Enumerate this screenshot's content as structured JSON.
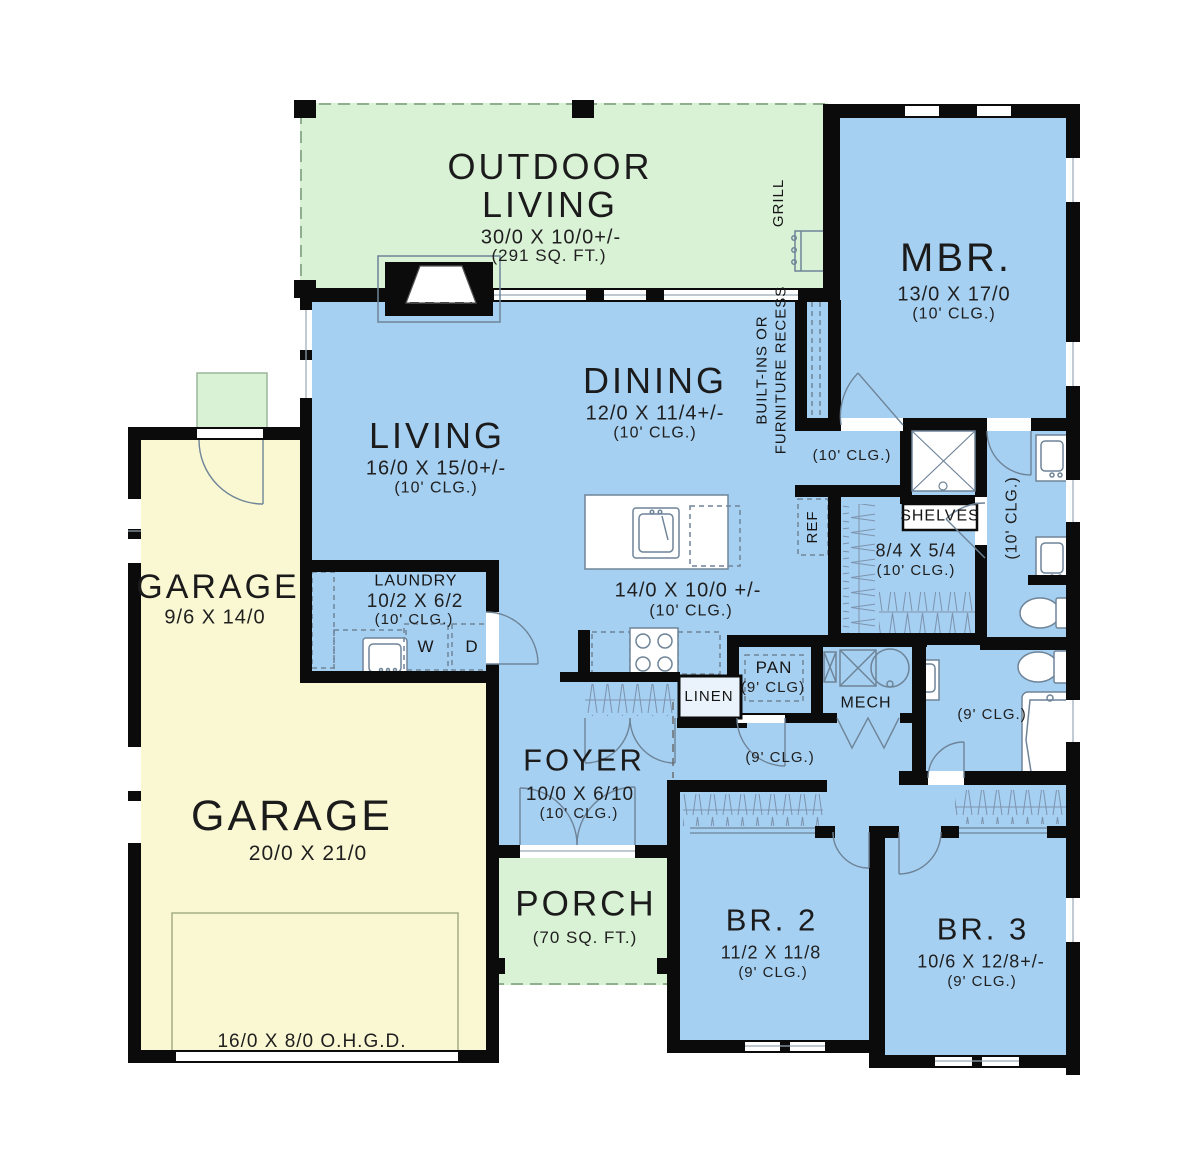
{
  "plan": {
    "colors": {
      "interior_blue": "#a6d0f2",
      "outdoor_green": "#d9f1d5",
      "garage_yellow": "#faf8d2",
      "wall_black": "#0b0b0b"
    },
    "rooms": {
      "outdoor_living": {
        "name": "OUTDOOR LIVING",
        "dims": "30/0 X 10/0+/-",
        "area": "(291 SQ. FT.)"
      },
      "mbr": {
        "name": "MBR.",
        "dims": "13/0 X 17/0",
        "clg": "(10' CLG.)"
      },
      "living": {
        "name": "LIVING",
        "dims": "16/0 X 15/0+/-",
        "clg": "(10' CLG.)"
      },
      "dining": {
        "name": "DINING",
        "dims": "12/0 X 11/4+/-",
        "clg": "(10' CLG.)"
      },
      "kitchen": {
        "dims": "14/0 X 10/0 +/-",
        "clg": "(10' CLG.)"
      },
      "hall_upper": {
        "clg": "(10' CLG.)"
      },
      "master_closet": {
        "dims": "8/4 X 5/4",
        "clg": "(10' CLG.)"
      },
      "master_bath": {
        "clg": "(10' CLG.)"
      },
      "laundry": {
        "name": "LAUNDRY",
        "dims": "10/2 X 6/2",
        "clg": "(10' CLG.)",
        "washer": "W",
        "dryer": "D"
      },
      "garage_small": {
        "name": "GARAGE",
        "dims": "9/6 X 14/0"
      },
      "garage_main": {
        "name": "GARAGE",
        "dims": "20/0 X 21/0",
        "door": "16/0 X 8/0 O.H.G.D."
      },
      "pantry": {
        "name": "PAN",
        "clg": "(9' CLG)"
      },
      "mech": {
        "name": "MECH"
      },
      "linen": {
        "name": "LINEN"
      },
      "bath2": {
        "clg": "(9' CLG.)"
      },
      "hall_bed": {
        "clg": "(9' CLG.)"
      },
      "foyer": {
        "name": "FOYER",
        "dims": "10/0 X 6/10",
        "clg": "(10' CLG.)"
      },
      "porch": {
        "name": "PORCH",
        "area": "(70 SQ. FT.)"
      },
      "br2": {
        "name": "BR. 2",
        "dims": "11/2 X 11/8",
        "clg": "(9' CLG.)"
      },
      "br3": {
        "name": "BR. 3",
        "dims": "10/6 X 12/8+/-",
        "clg": "(9' CLG.)"
      }
    },
    "labels": {
      "grill": "GRILL",
      "builtins_line1": "BUILT-INS OR",
      "builtins_line2": "FURNITURE RECESS",
      "ref": "REF",
      "shelves": "SHELVES"
    }
  }
}
